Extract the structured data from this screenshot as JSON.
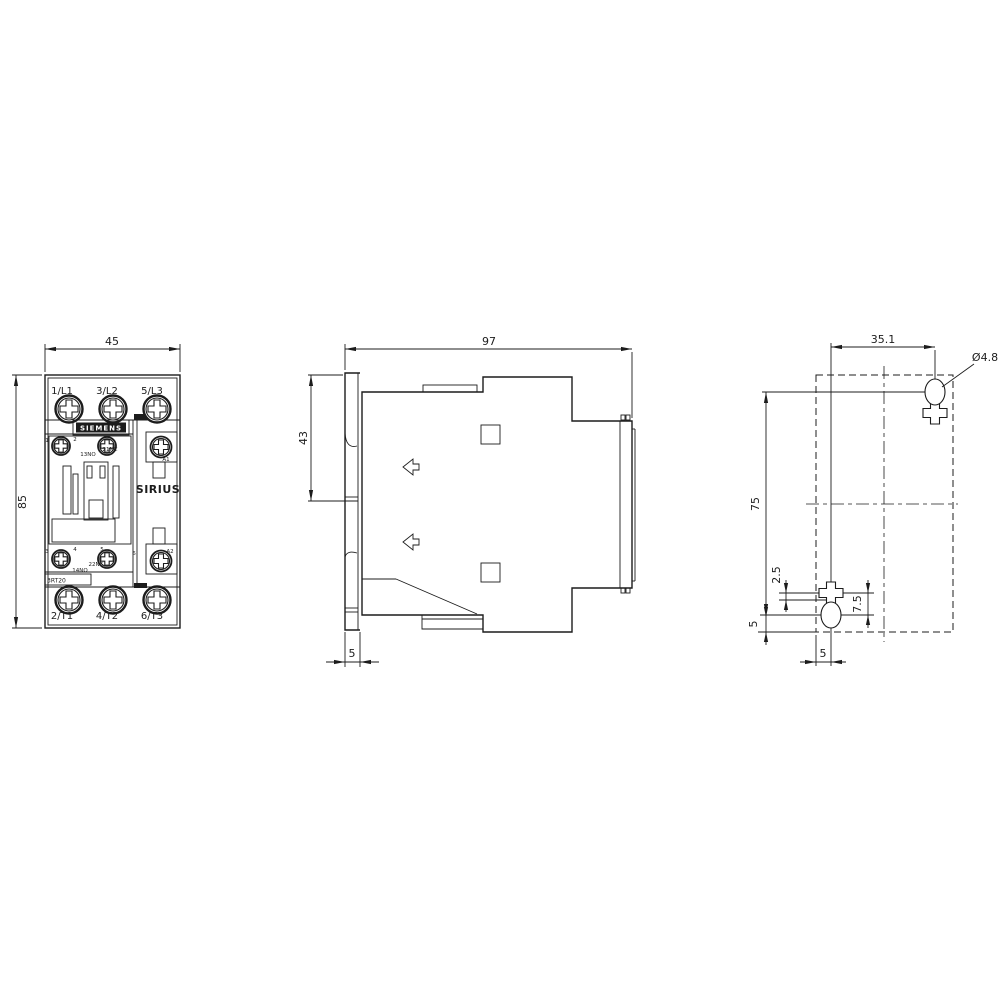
{
  "drawing": {
    "front": {
      "dim_width": "45",
      "dim_height": "85",
      "terminals_top": [
        "1/L1",
        "3/L2",
        "5/L3"
      ],
      "terminals_bottom": [
        "2/T1",
        "4/T2",
        "6/T3"
      ],
      "brand": "SIEMENS",
      "series": "SIRIUS",
      "model": "3RT20",
      "aux_top": {
        "d1": "1",
        "d2": "2",
        "no": "13NO",
        "nc": "21NC",
        "coil": "A1"
      },
      "aux_bottom": {
        "d3": "3",
        "d4": "4",
        "d5": "5",
        "d6": "6",
        "no": "14NO",
        "nc": "22NC",
        "coil": "A2"
      }
    },
    "side": {
      "dim_depth": "97",
      "dim_height_upper": "43",
      "dim_rail_thickness": "5"
    },
    "drill": {
      "dim_horizontal": "35.1",
      "hole_diameter": "Ø4.8",
      "dim_vertical": "75",
      "dim_offset": "2.5",
      "dim_keyhole": "7.5",
      "dim_edge_left": "5",
      "dim_edge_bottom": "5"
    },
    "line_color": "#1c1c1c",
    "background": "#ffffff"
  }
}
